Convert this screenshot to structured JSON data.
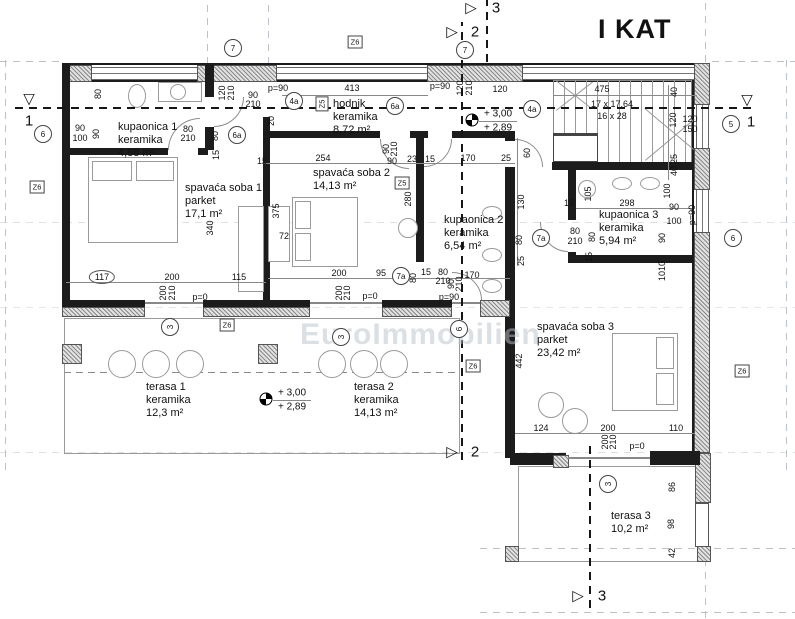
{
  "title": "I KAT",
  "watermark": "EuroImmobilien",
  "rooms": [
    {
      "lines": [
        "kupaonica 1",
        "keramika",
        "4,88 m²"
      ],
      "x": 118,
      "y": 121
    },
    {
      "lines": [
        "spavaća soba 1",
        "parket",
        "17,1 m²"
      ],
      "x": 185,
      "y": 182
    },
    {
      "lines": [
        "spavaća soba 2",
        "14,13 m²"
      ],
      "x": 313,
      "y": 167
    },
    {
      "lines": [
        "hodnik",
        "keramika",
        "8,72 m²"
      ],
      "x": 333,
      "y": 98
    },
    {
      "lines": [
        "kupaonica 2",
        "keramika",
        "6,54 m²"
      ],
      "x": 444,
      "y": 214
    },
    {
      "lines": [
        "kupaonica 3",
        "keramika",
        "5,94 m²"
      ],
      "x": 599,
      "y": 209
    },
    {
      "lines": [
        "spavaća soba 3",
        "parket",
        "23,42 m²"
      ],
      "x": 537,
      "y": 321
    },
    {
      "lines": [
        "terasa 1",
        "keramika",
        "12,3 m²"
      ],
      "x": 146,
      "y": 381
    },
    {
      "lines": [
        "terasa 2",
        "keramika",
        "14,13 m²"
      ],
      "x": 354,
      "y": 381
    },
    {
      "lines": [
        "terasa 3",
        "10,2 m²"
      ],
      "x": 611,
      "y": 510
    }
  ],
  "stair_note": {
    "lines": [
      "17 x 17,64",
      "16 x 28"
    ],
    "x": 612,
    "y": 98
  },
  "levels": [
    {
      "l1": "+ 3,00",
      "l2": "+ 2,89",
      "x": 472,
      "y": 120
    },
    {
      "l1": "+ 3,00",
      "l2": "+ 2,89",
      "x": 266,
      "y": 399
    }
  ],
  "sections": [
    {
      "sym": "▽",
      "num": "1",
      "sx": 29,
      "sy": 99,
      "nx": 29,
      "ny": 121
    },
    {
      "sym": "▽",
      "num": "1",
      "sx": 747,
      "sy": 100,
      "nx": 751,
      "ny": 122
    },
    {
      "sym": "▷",
      "num": "3",
      "sx": 471,
      "sy": 8,
      "nx": 496,
      "ny": 8
    },
    {
      "sym": "▷",
      "num": "2",
      "sx": 452,
      "sy": 32,
      "nx": 475,
      "ny": 32
    },
    {
      "sym": "▷",
      "num": "2",
      "sx": 452,
      "sy": 452,
      "nx": 475,
      "ny": 452
    },
    {
      "sym": "▷",
      "num": "3",
      "sx": 578,
      "sy": 596,
      "nx": 602,
      "ny": 596
    }
  ],
  "grid_bubbles": [
    {
      "t": "7",
      "x": 233,
      "y": 48
    },
    {
      "t": "7",
      "x": 465,
      "y": 50
    },
    {
      "t": "6",
      "x": 43,
      "y": 134
    },
    {
      "t": "6a",
      "x": 237,
      "y": 135
    },
    {
      "t": "4a",
      "x": 294,
      "y": 101
    },
    {
      "t": "6a",
      "x": 395,
      "y": 106
    },
    {
      "t": "4a",
      "x": 532,
      "y": 109
    },
    {
      "t": "5",
      "x": 731,
      "y": 124
    },
    {
      "t": "6",
      "x": 733,
      "y": 238
    },
    {
      "t": "7a",
      "x": 541,
      "y": 238
    },
    {
      "t": "7a",
      "x": 401,
      "y": 276
    },
    {
      "t": "3",
      "x": 170,
      "y": 327,
      "r": 1
    },
    {
      "t": "3",
      "x": 341,
      "y": 337,
      "r": 1
    },
    {
      "t": "6",
      "x": 459,
      "y": 329,
      "r": 1
    },
    {
      "t": "3",
      "x": 608,
      "y": 484,
      "r": 1
    }
  ],
  "zone_labels": [
    {
      "t": "Z6",
      "x": 37,
      "y": 187
    },
    {
      "t": "Z6",
      "x": 355,
      "y": 42
    },
    {
      "t": "Z5",
      "x": 322,
      "y": 104,
      "r": 1
    },
    {
      "t": "Z5",
      "x": 402,
      "y": 183
    },
    {
      "t": "Z6",
      "x": 227,
      "y": 325
    },
    {
      "t": "Z6",
      "x": 473,
      "y": 366
    },
    {
      "t": "Z6",
      "x": 742,
      "y": 371
    }
  ],
  "dimensions": [
    {
      "t": "p=90",
      "x": 278,
      "y": 88
    },
    {
      "t": "413",
      "x": 352,
      "y": 88
    },
    {
      "t": "p=90",
      "x": 440,
      "y": 86
    },
    {
      "t": "120",
      "x": 500,
      "y": 89
    },
    {
      "t": "475",
      "x": 602,
      "y": 89
    },
    {
      "t": "120",
      "x": 460,
      "y": 88,
      "r": 1
    },
    {
      "t": "210",
      "x": 469,
      "y": 88,
      "r": 1
    },
    {
      "t": "120",
      "x": 222,
      "y": 93,
      "r": 1
    },
    {
      "t": "210",
      "x": 231,
      "y": 93,
      "r": 1
    },
    {
      "t": "90",
      "x": 253,
      "y": 95
    },
    {
      "t": "210",
      "x": 253,
      "y": 104
    },
    {
      "t": "80",
      "x": 98,
      "y": 94,
      "r": 1
    },
    {
      "t": "90",
      "x": 80,
      "y": 128
    },
    {
      "t": "100",
      "x": 80,
      "y": 138
    },
    {
      "t": "90",
      "x": 96,
      "y": 134,
      "r": 1
    },
    {
      "t": "80",
      "x": 188,
      "y": 129
    },
    {
      "t": "210",
      "x": 188,
      "y": 138
    },
    {
      "t": "80",
      "x": 215,
      "y": 136,
      "r": 1
    },
    {
      "t": "15",
      "x": 216,
      "y": 155,
      "r": 1
    },
    {
      "t": "15",
      "x": 262,
      "y": 161
    },
    {
      "t": "254",
      "x": 323,
      "y": 158
    },
    {
      "t": "90",
      "x": 386,
      "y": 149,
      "r": 1
    },
    {
      "t": "210",
      "x": 394,
      "y": 149,
      "r": 1
    },
    {
      "t": "90",
      "x": 392,
      "y": 161
    },
    {
      "t": "23",
      "x": 412,
      "y": 159
    },
    {
      "t": "15",
      "x": 430,
      "y": 159
    },
    {
      "t": "170",
      "x": 468,
      "y": 158
    },
    {
      "t": "25",
      "x": 506,
      "y": 158
    },
    {
      "t": "20",
      "x": 271,
      "y": 121,
      "r": 1
    },
    {
      "t": "15",
      "x": 267,
      "y": 136,
      "r": 1
    },
    {
      "t": "340",
      "x": 210,
      "y": 228,
      "r": 1
    },
    {
      "t": "375",
      "x": 276,
      "y": 211,
      "r": 1
    },
    {
      "t": "72",
      "x": 284,
      "y": 236
    },
    {
      "t": "117",
      "x": 102,
      "y": 277,
      "cls": "pill"
    },
    {
      "t": "200",
      "x": 172,
      "y": 277
    },
    {
      "t": "115",
      "x": 239,
      "y": 277
    },
    {
      "t": "200",
      "x": 163,
      "y": 293,
      "r": 1
    },
    {
      "t": "210",
      "x": 172,
      "y": 293,
      "r": 1
    },
    {
      "t": "p=0",
      "x": 200,
      "y": 297
    },
    {
      "t": "280",
      "x": 408,
      "y": 199,
      "r": 1
    },
    {
      "t": "200",
      "x": 339,
      "y": 273
    },
    {
      "t": "95",
      "x": 381,
      "y": 273
    },
    {
      "t": "80",
      "x": 413,
      "y": 278,
      "r": 1
    },
    {
      "t": "15",
      "x": 426,
      "y": 272
    },
    {
      "t": "80",
      "x": 443,
      "y": 272
    },
    {
      "t": "210",
      "x": 443,
      "y": 281
    },
    {
      "t": "170",
      "x": 472,
      "y": 275
    },
    {
      "t": "200",
      "x": 339,
      "y": 293,
      "r": 1
    },
    {
      "t": "210",
      "x": 347,
      "y": 293,
      "r": 1
    },
    {
      "t": "p=0",
      "x": 370,
      "y": 296
    },
    {
      "t": "90",
      "x": 451,
      "y": 284,
      "r": 1
    },
    {
      "t": "210",
      "x": 459,
      "y": 284,
      "r": 1
    },
    {
      "t": "p=90",
      "x": 449,
      "y": 297
    },
    {
      "t": "60",
      "x": 527,
      "y": 153,
      "r": 1
    },
    {
      "t": "130",
      "x": 521,
      "y": 202,
      "r": 1
    },
    {
      "t": "80",
      "x": 519,
      "y": 240,
      "r": 1
    },
    {
      "t": "25",
      "x": 521,
      "y": 261,
      "r": 1
    },
    {
      "t": "40",
      "x": 674,
      "y": 92,
      "r": 1
    },
    {
      "t": "120",
      "x": 673,
      "y": 120,
      "r": 1
    },
    {
      "t": "25",
      "x": 674,
      "y": 159,
      "r": 1
    },
    {
      "t": "40",
      "x": 674,
      "y": 171,
      "r": 1
    },
    {
      "t": "120",
      "x": 690,
      "y": 119
    },
    {
      "t": "150",
      "x": 690,
      "y": 129
    },
    {
      "t": "105",
      "x": 588,
      "y": 194,
      "r": 1
    },
    {
      "t": "15",
      "x": 569,
      "y": 203
    },
    {
      "t": "298",
      "x": 627,
      "y": 203
    },
    {
      "t": "100",
      "x": 667,
      "y": 191,
      "r": 1
    },
    {
      "t": "90",
      "x": 674,
      "y": 207
    },
    {
      "t": "100",
      "x": 674,
      "y": 221
    },
    {
      "t": "p=90",
      "x": 692,
      "y": 215,
      "r": 1
    },
    {
      "t": "90",
      "x": 662,
      "y": 238,
      "r": 1
    },
    {
      "t": "1010",
      "x": 662,
      "y": 271,
      "r": 1
    },
    {
      "t": "80",
      "x": 575,
      "y": 231
    },
    {
      "t": "210",
      "x": 575,
      "y": 241
    },
    {
      "t": "80",
      "x": 592,
      "y": 237,
      "r": 1
    },
    {
      "t": "15",
      "x": 589,
      "y": 257,
      "r": 1
    },
    {
      "t": "442",
      "x": 519,
      "y": 361,
      "r": 1
    },
    {
      "t": "124",
      "x": 541,
      "y": 428
    },
    {
      "t": "200",
      "x": 608,
      "y": 428
    },
    {
      "t": "110",
      "x": 676,
      "y": 428
    },
    {
      "t": "200",
      "x": 605,
      "y": 442,
      "r": 1
    },
    {
      "t": "210",
      "x": 613,
      "y": 442,
      "r": 1
    },
    {
      "t": "p=0",
      "x": 637,
      "y": 446
    },
    {
      "t": "86",
      "x": 672,
      "y": 487,
      "r": 1
    },
    {
      "t": "98",
      "x": 671,
      "y": 524,
      "r": 1
    },
    {
      "t": "42",
      "x": 672,
      "y": 553,
      "r": 1
    }
  ]
}
